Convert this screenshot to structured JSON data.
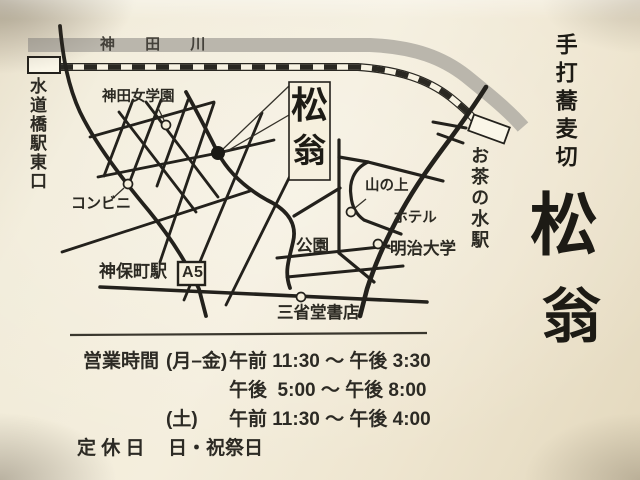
{
  "shop": {
    "style_label": "手打蕎麦切",
    "name_char1": "松",
    "name_char2": "翁"
  },
  "map": {
    "river_label": "神 田 川",
    "stations": {
      "suidobashi": "水道橋駅東口",
      "ochanomizu": "お茶の水駅",
      "jimbocho": "神保町駅",
      "exit_label": "A5"
    },
    "landmarks": {
      "school": "神田女学園",
      "convenience_store": "コンビニ",
      "park": "公園",
      "hotel_line1": "山の上",
      "hotel_line2": "ホテル",
      "university": "明治大学",
      "bookstore": "三省堂書店"
    },
    "shop_box": {
      "char1": "松",
      "char2": "翁"
    }
  },
  "hours": {
    "heading": "営業時間",
    "rows": [
      {
        "days": "(月–金)",
        "time": "午前 11:30 ～ 午後 3:30"
      },
      {
        "days": "",
        "time": "午後  5:00 ～ 午後 8:00"
      },
      {
        "days": "(土)",
        "time": "午前 11:30 ～ 午後 4:00"
      }
    ],
    "closed_label": "定 休 日",
    "closed_value": "日・祝祭日"
  },
  "colors": {
    "card": "#f2ecda",
    "ink": "#23211c",
    "river": "#bab6ac"
  }
}
